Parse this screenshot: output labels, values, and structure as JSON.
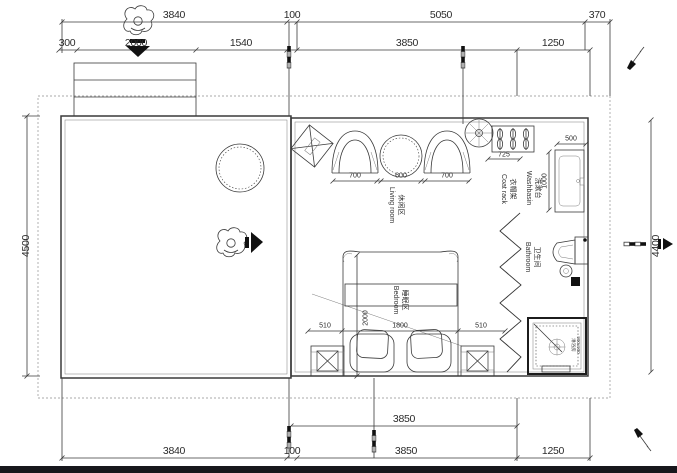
{
  "meta": {
    "drawing_type": "architectural floor plan"
  },
  "colors": {
    "line": "#3a3a3a",
    "accent_black": "#111111",
    "boundary_dotted": "#8f8f8f",
    "background": "#ffffff",
    "bottom_bar": "#17171c"
  },
  "dims": {
    "top_row_outer": {
      "d3840": "3840",
      "d100": "100",
      "d5050": "5050",
      "d370": "370"
    },
    "top_row_inner": {
      "d300": "300",
      "d2000": "2000",
      "d1540": "1540",
      "d3850": "3850",
      "d1250": "1250"
    },
    "left_side": "4500",
    "right_side": "4400",
    "bottom_row_inner": {
      "d3850": "3850"
    },
    "bottom_row_outer": {
      "d3840": "3840",
      "d100": "100",
      "d3850": "3850",
      "d1250": "1250"
    },
    "living": {
      "chair_left": "700",
      "table": "600",
      "chair_right": "700"
    },
    "coat_rack": "725",
    "washbasin": {
      "width": "500",
      "depth": "1000"
    },
    "bed": {
      "side_left": "510",
      "width": "1800",
      "side_right": "510",
      "length": "2000"
    },
    "shower_size": "900x900"
  },
  "rooms": {
    "living": {
      "zh": "休闲区",
      "en": "Living room"
    },
    "bedroom": {
      "zh": "睡眠区",
      "en": "Bedroom"
    },
    "bathroom": {
      "zh": "卫生间",
      "en": "Bathroom"
    },
    "washbasin": {
      "zh": "洗漱台",
      "en": "Washbasin"
    },
    "coat_rack": {
      "zh": "衣帽架",
      "en": "Coat rack"
    },
    "shower": {
      "zh": "淋浴房"
    }
  },
  "icons": {
    "person-top-view": "human figure viewed from above (entry indicator)",
    "entry-arrow": "solid black arrow showing entry direction",
    "plant": "round potted plant symbol",
    "pen-marker": "diagonal pen annotation symbol",
    "survey-pole": "black and white striped level rod",
    "section-arrow": "solid arrow marker at right edge"
  }
}
